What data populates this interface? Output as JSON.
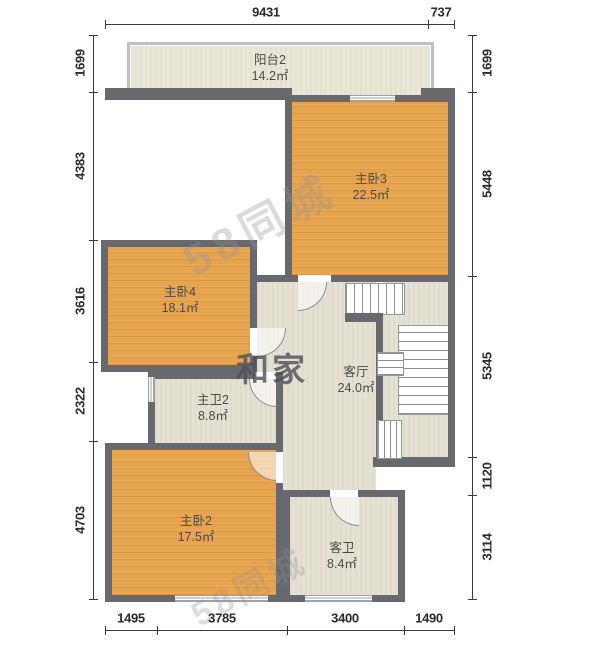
{
  "watermarks": {
    "site": "58同城",
    "portal": "和家"
  },
  "rooms": {
    "balcony2": {
      "name": "阳台2",
      "area": "14.2㎡"
    },
    "master3": {
      "name": "主卧3",
      "area": "22.5㎡"
    },
    "master4": {
      "name": "主卧4",
      "area": "18.1㎡"
    },
    "masterbath2": {
      "name": "主卫2",
      "area": "8.8㎡"
    },
    "master2": {
      "name": "主卧2",
      "area": "17.5㎡"
    },
    "guestbath": {
      "name": "客卫",
      "area": "8.4㎡"
    },
    "hall": {
      "name": "客厅",
      "area": "24.0㎡"
    }
  },
  "dimensions": {
    "top": [
      "9431",
      "737"
    ],
    "bottom": [
      "1495",
      "3785",
      "3400",
      "1490"
    ],
    "left": [
      "1699",
      "4383",
      "3616",
      "2322",
      "4703"
    ],
    "right": [
      "1699",
      "5448",
      "5345",
      "1120",
      "3114"
    ]
  },
  "colors": {
    "wall": "#67696f",
    "bedroom_floor": "#e7a44e",
    "tile_floor": "#e4e1d2",
    "balcony_floor": "#e8e5d7"
  }
}
